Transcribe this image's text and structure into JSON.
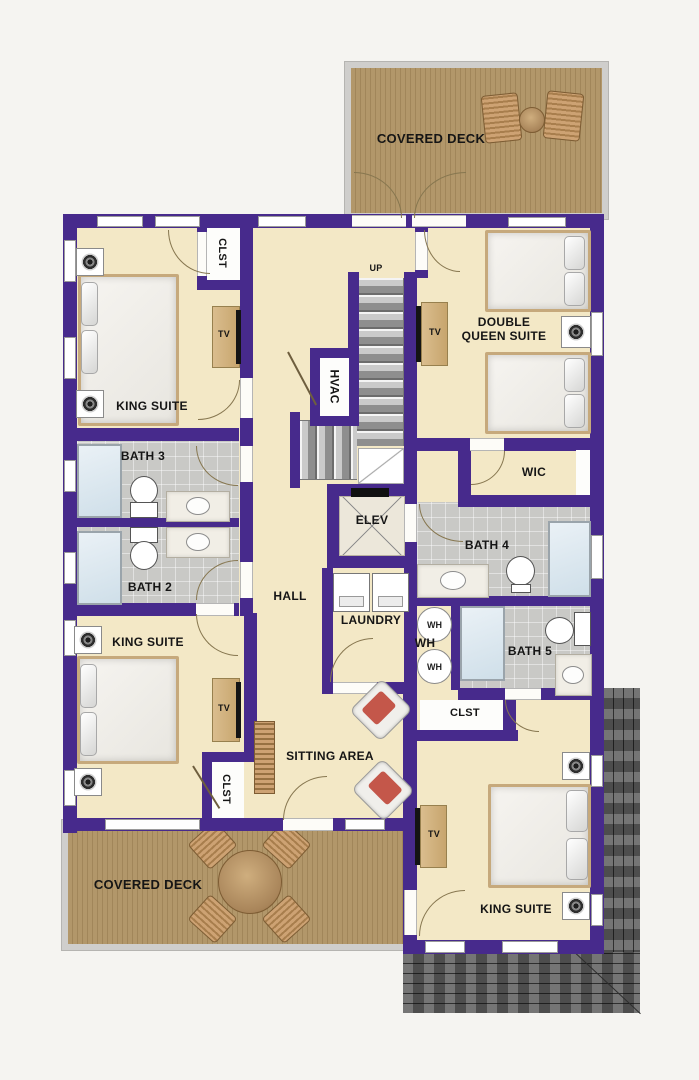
{
  "decks": {
    "top_label": "COVERED DECK",
    "bottom_label": "COVERED DECK"
  },
  "rooms": {
    "king_suite_top": "KING SUITE",
    "king_suite_middle": "KING SUITE",
    "king_suite_bottom": "KING SUITE",
    "double_queen_line1": "DOUBLE",
    "double_queen_line2": "QUEEN SUITE",
    "sitting_area": "SITTING AREA",
    "hall": "HALL",
    "wic": "WIC",
    "laundry": "LAUNDRY",
    "bath_2": "BATH 2",
    "bath_3": "BATH 3",
    "bath_4": "BATH 4",
    "bath_5": "BATH 5"
  },
  "closets": {
    "top": "CLST",
    "bottom_left": "CLST",
    "bottom_right": "CLST"
  },
  "utility": {
    "elevator": "ELEV",
    "hvac": "HVAC",
    "stairs_up": "UP",
    "water_heater_label": "WH",
    "water_heater_1": "WH",
    "water_heater_2": "WH"
  },
  "fixtures": {
    "tv": "TV"
  },
  "colors": {
    "wall": "#472a8c",
    "floor": "#f3e8c6",
    "deck_wood": "#b2976a",
    "bath_tile": "#c9c9c6",
    "roof_shingle": "#5e5e5e",
    "background": "#f5f4f1",
    "shower_glass": "#dfe9f1",
    "armchair_cushion": "#c4574a"
  }
}
